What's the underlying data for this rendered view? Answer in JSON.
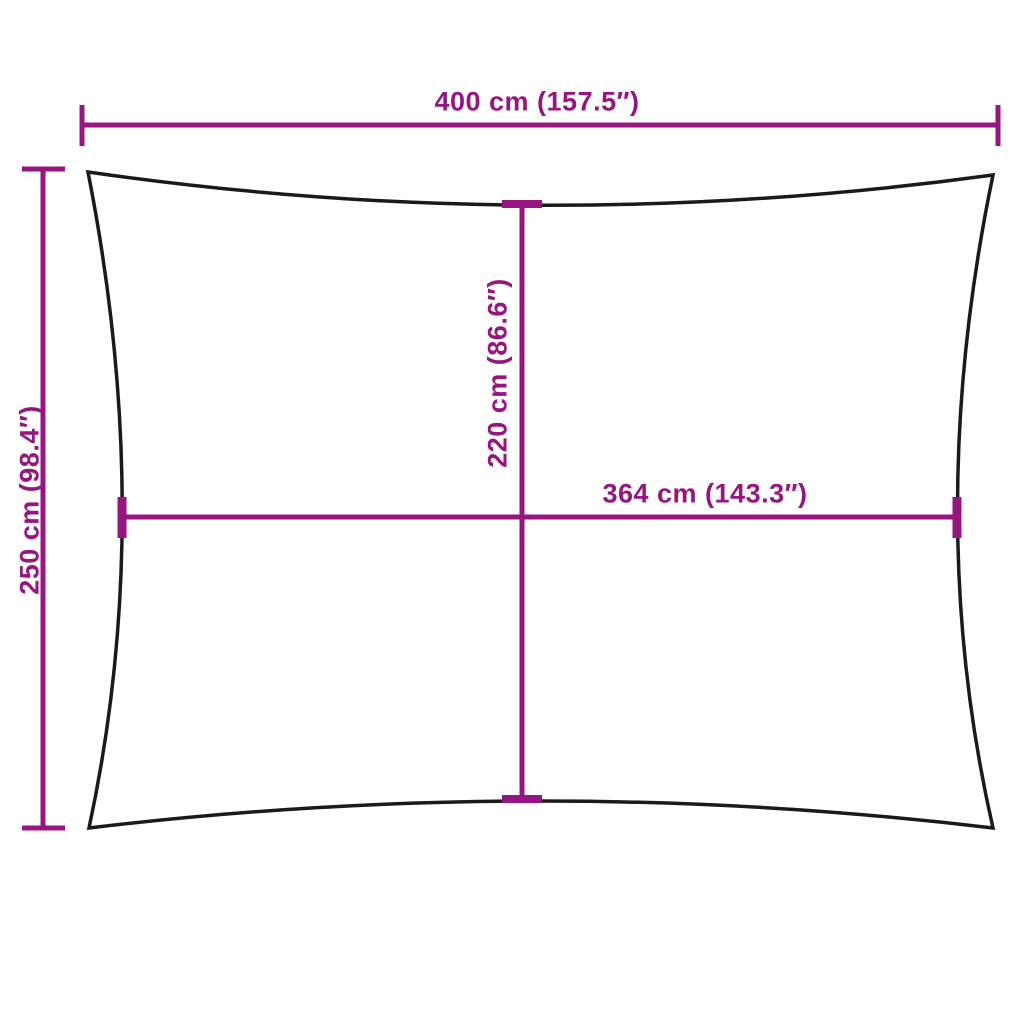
{
  "diagram_title": "rectangular-sail-dimension-diagram",
  "colors": {
    "dimension": "#971580",
    "outline": "#1a1a1a",
    "background": "#ffffff"
  },
  "dimensions": {
    "outer_width": {
      "label": "400 cm (157.5″)",
      "cm": 400,
      "in": 157.5
    },
    "outer_height": {
      "label": "250 cm (98.4″)",
      "cm": 250,
      "in": 98.4
    },
    "inner_height": {
      "label": "220 cm (86.6″)",
      "cm": 220,
      "in": 86.6
    },
    "inner_width": {
      "label": "364 cm (143.3″)",
      "cm": 364,
      "in": 143.3
    }
  }
}
